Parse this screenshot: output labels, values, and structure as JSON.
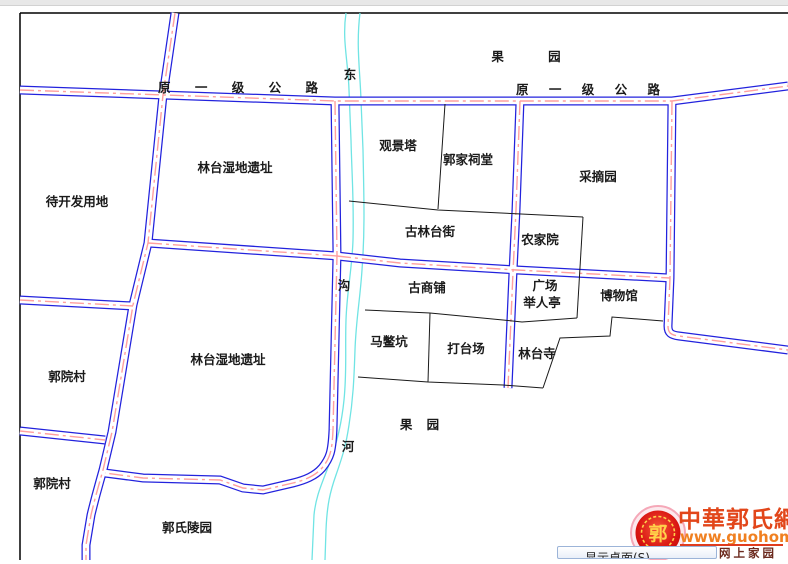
{
  "map": {
    "labels": [
      {
        "text": "果 园"
      },
      {
        "text": "原 一 级 公 路"
      },
      {
        "text": "原 一 级 公 路"
      },
      {
        "text": "东"
      },
      {
        "text": "观景塔"
      },
      {
        "text": "郭家祠堂"
      },
      {
        "text": "采摘园"
      },
      {
        "text": "林台湿地遗址"
      },
      {
        "text": "待开发用地"
      },
      {
        "text": "古林台街"
      },
      {
        "text": "农家院"
      },
      {
        "text": "沟"
      },
      {
        "text": "古商铺"
      },
      {
        "text": "广场"
      },
      {
        "text": "举人亭"
      },
      {
        "text": "博物馆"
      },
      {
        "text": "马鳖坑"
      },
      {
        "text": "打台场"
      },
      {
        "text": "林台寺"
      },
      {
        "text": "郭院村"
      },
      {
        "text": "林台湿地遗址"
      },
      {
        "text": "郭院村"
      },
      {
        "text": "河"
      },
      {
        "text": "果 园"
      },
      {
        "text": "郭氏陵园"
      }
    ],
    "colors": {
      "road_edge": "#2222dd",
      "road_center": "#ff9f9f",
      "river": "#70e4e4",
      "parcel_line": "#1a1a1a",
      "frame": "#000000"
    }
  },
  "watermark": {
    "site_name": "中華郭氏網",
    "url": "www.guohome.org",
    "tagline": "郭氏网上家园",
    "seal_char": "郭",
    "colors": {
      "title": "#e2461a",
      "url": "#f08020",
      "seal_red": "#d81410",
      "seal_gold": "#ffd24a"
    }
  },
  "tooltip": {
    "text": "显示桌面(S)"
  }
}
